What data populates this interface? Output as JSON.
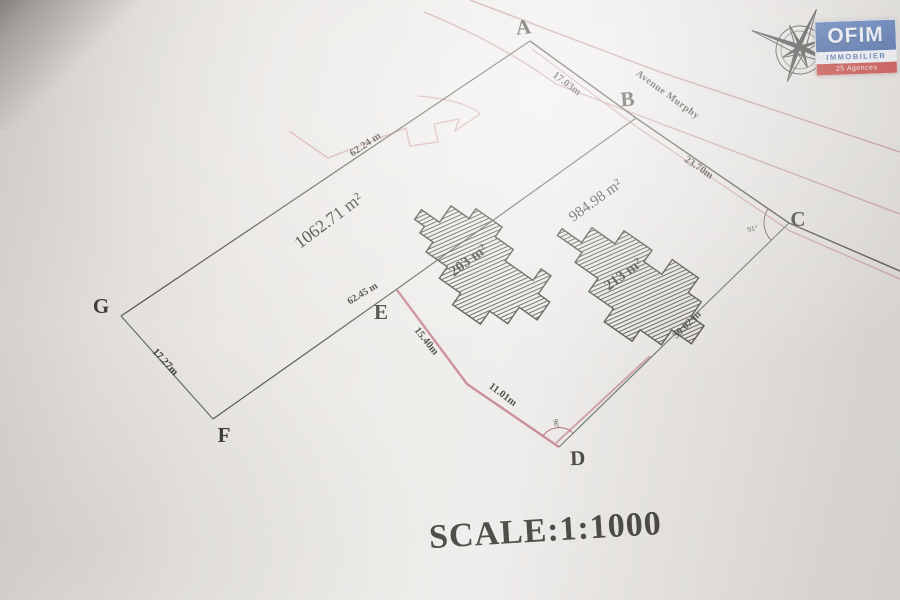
{
  "plan": {
    "scale_label": "SCALE:1:1000",
    "street_name": "Avenue Murphy",
    "points": {
      "a": "A",
      "b": "B",
      "c": "C",
      "d": "D",
      "e": "E",
      "f": "F",
      "g": "G"
    },
    "measurements": {
      "ab": "17.03m",
      "bc": "23.70m",
      "cd": "39.02 m",
      "xd": "11.01m",
      "ex": "15.40m",
      "division": "62.45 m",
      "gf": "17.27m",
      "ag": "62.24 m"
    },
    "areas": {
      "lot_west": "1062.71 m²",
      "lot_east": "984.98 m²",
      "building_west": "203 m²",
      "building_east": "213 m²"
    },
    "angles": {
      "at_c": "91°",
      "at_d": "96°"
    }
  },
  "logo": {
    "brand": "OFIM",
    "subtitle": "IMMOBILIER",
    "banner": "25 Agences"
  },
  "colors": {
    "ink": "#3a3833",
    "boundary": "#4a4840",
    "hedge_green": "#5e6f60",
    "road_pink": "#c18b93",
    "division_pink": "#bd6f7d",
    "logo_blue": "#3b5fa8",
    "logo_red": "#c2312d",
    "paper": "#e9e6e2"
  }
}
